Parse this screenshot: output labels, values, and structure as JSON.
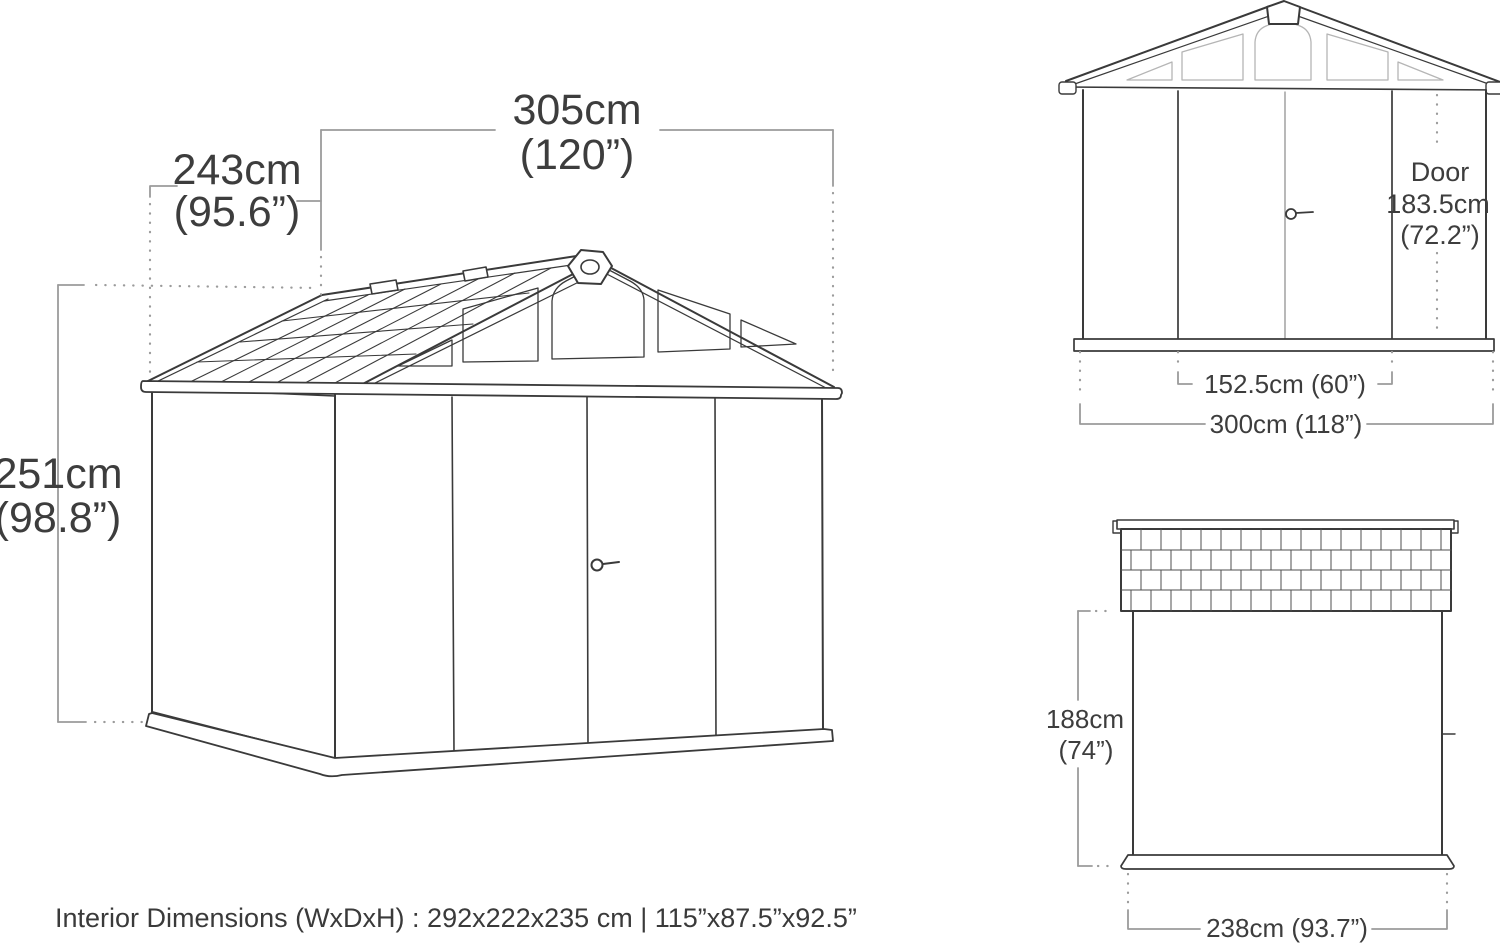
{
  "colors": {
    "line": "#3a3a3a",
    "dim": "#9b9b9b",
    "light_window": "#b5b5b5",
    "text": "#3d3d3d",
    "background": "#ffffff"
  },
  "perspective_view": {
    "width_cm": "305cm",
    "width_in": "(120”)",
    "depth_cm": "243cm",
    "depth_in": "(95.6”)",
    "height_cm": "251cm",
    "height_in": "(98.8”)"
  },
  "front_view": {
    "door_title": "Door",
    "door_height_cm": "183.5cm",
    "door_height_in": "(72.2”)",
    "door_width": "152.5cm (60”)",
    "overall_width": "300cm (118”)"
  },
  "side_view": {
    "height_cm": "188cm",
    "height_in": "(74”)",
    "depth": "238cm (93.7”)"
  },
  "footer": {
    "interior_dimensions": "Interior Dimensions (WxDxH) : 292x222x235 cm | 115”x87.5”x92.5”"
  }
}
